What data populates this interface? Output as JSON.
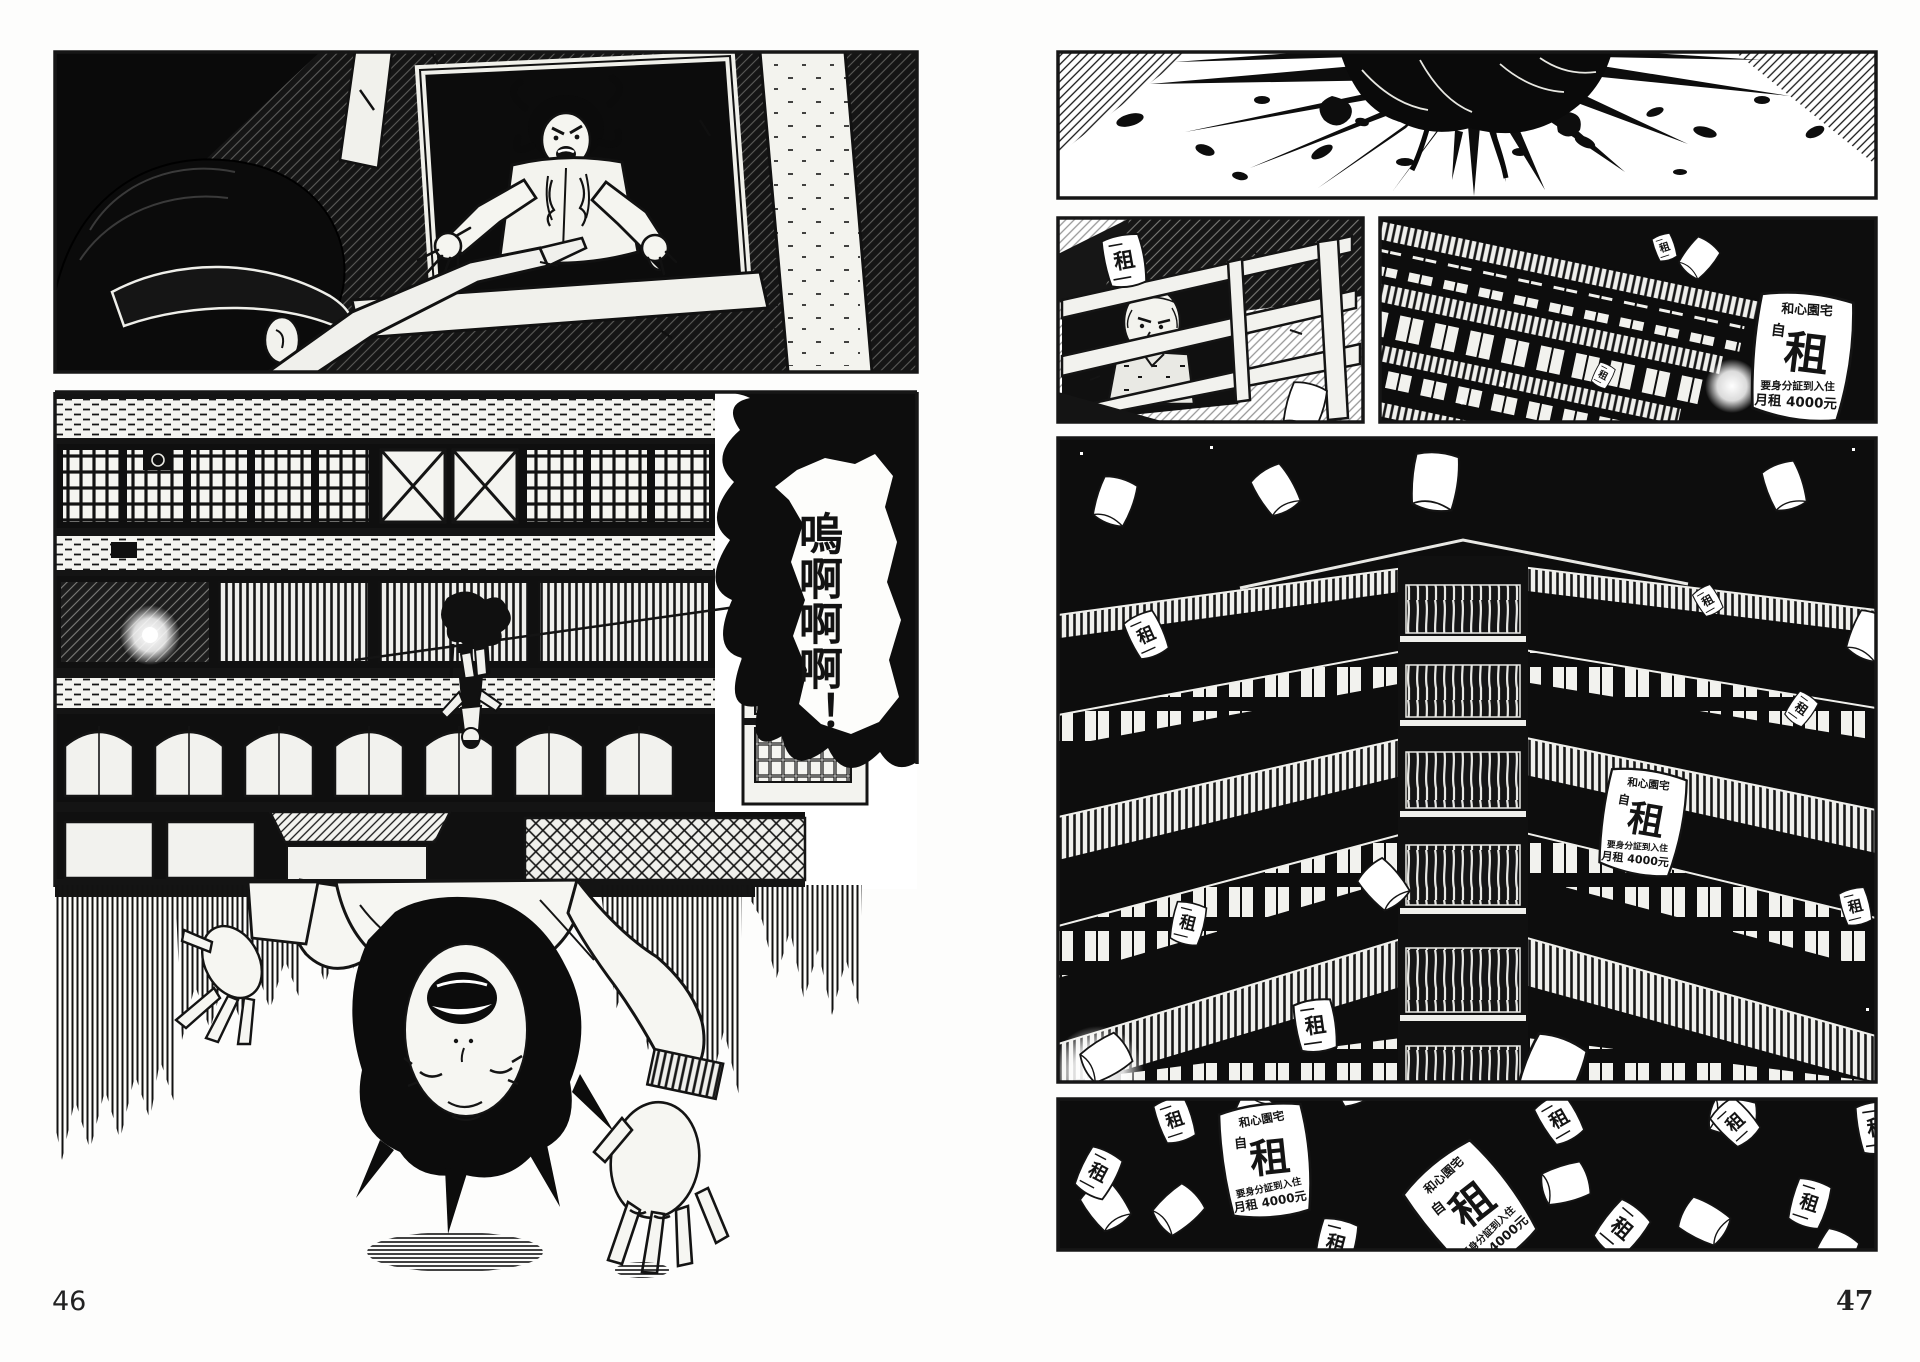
{
  "pages": {
    "left_number": "46",
    "right_number": "47"
  },
  "left_page": {
    "scream_text": "嗚啊啊啊！",
    "scene_top": "man-in-cap-reaching-toward-woman-in-window",
    "scene_bottom": "apartment-facade-with-tiny-falling-figure-and-upside-down-screaming-woman"
  },
  "right_page": {
    "scene_1": "impact-splatter-burst",
    "scene_2": "man-looking-down-from-window",
    "scene_3": "building-corner-with-flying-rent-flyer",
    "scene_4": "apartment-building-worms-eye-night-with-flyers",
    "scene_5": "scattered-rent-flyers-on-black"
  },
  "rent_flyer": {
    "building_name": "和心園宅",
    "self_char": "自",
    "rent_char": "租",
    "condition": "要身分証到入住",
    "price": "月租 4000元"
  },
  "small_flyer": {
    "rent_char": "租"
  },
  "colors": {
    "ink": "#141414",
    "paper": "#ffffff"
  }
}
